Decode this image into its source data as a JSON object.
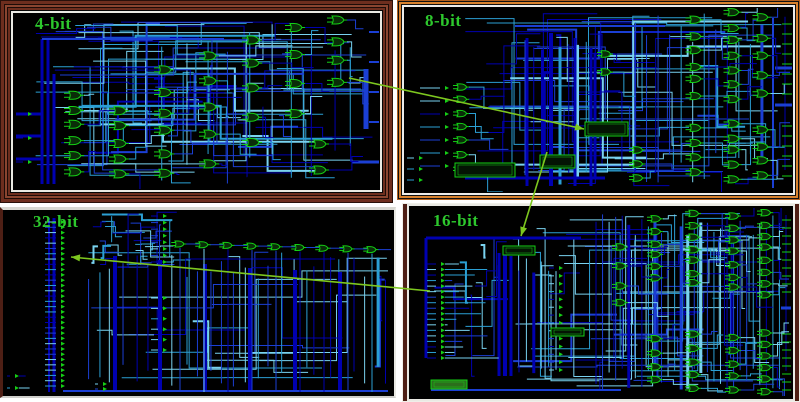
{
  "figure_type": "logic-circuit schematic comparison",
  "panels": [
    {
      "id": "4bit",
      "label": "4-bit"
    },
    {
      "id": "8bit",
      "label": "8-bit"
    },
    {
      "id": "32bit",
      "label": "32-bit"
    },
    {
      "id": "16bit",
      "label": "16-bit"
    }
  ],
  "annotations": {
    "arrows": [
      {
        "name": "arrow-4bit-to-8bit",
        "from": "4-bit",
        "to": "8-bit",
        "x1": 349,
        "y1": 78,
        "x2": 584,
        "y2": 129
      },
      {
        "name": "arrow-8bit-to-16bit",
        "from": "8-bit",
        "to": "16-bit",
        "x1": 547,
        "y1": 152,
        "x2": 521,
        "y2": 236
      },
      {
        "name": "arrow-16bit-to-32bit",
        "from": "16-bit",
        "to": "32-bit",
        "x1": 430,
        "y1": 291,
        "x2": 71,
        "y2": 257
      }
    ]
  },
  "colors": {
    "page_bg": "#ffffff",
    "canvas_bg": "#000000",
    "label_green": "#2dc82d",
    "gate_green": "#15cf15",
    "gate_fill": "#0a2d08",
    "block_fill": "#2c6e1c",
    "wire_darkblue": "#0000b0",
    "wire_blue": "#1b3fd4",
    "wire_cyan": "#2b9fd4",
    "wire_lightcyan": "#79d2ef",
    "arrow_green": "#7dc71f",
    "frame_maroon": "#6e2e1e",
    "frame_maroon_light": "#8a4530",
    "frame_orange": "#d8822e",
    "frame_white": "#e9e9e3"
  }
}
